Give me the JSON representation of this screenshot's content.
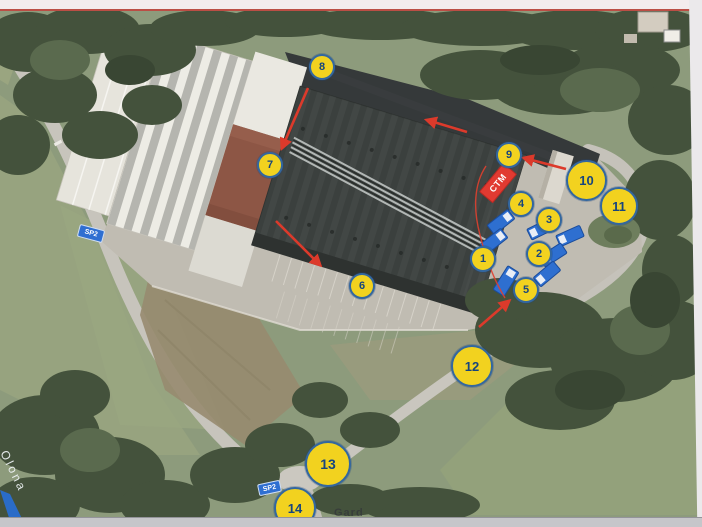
{
  "map": {
    "markers": [
      {
        "label": "1"
      },
      {
        "label": "2"
      },
      {
        "label": "3"
      },
      {
        "label": "4"
      },
      {
        "label": "5"
      },
      {
        "label": "6"
      },
      {
        "label": "7"
      },
      {
        "label": "8"
      },
      {
        "label": "9"
      },
      {
        "label": "10"
      },
      {
        "label": "11"
      },
      {
        "label": "12"
      },
      {
        "label": "13"
      },
      {
        "label": "14"
      }
    ],
    "ctm": {
      "label": "CTM"
    },
    "road_signs": {
      "sp_left": "SP2",
      "sp_junction": "SP2"
    },
    "labels": {
      "river": "Olona",
      "bottom_partial": "Gard"
    },
    "colors": {
      "marker_fill": "#f2d21f",
      "marker_border": "#33679f",
      "marker_text": "#17457e",
      "arrow_red": "#dc3a2b",
      "ctm_red": "#e13a31",
      "truck_blue": "#2e6fd0",
      "sign_blue": "#2f6fd1"
    }
  }
}
